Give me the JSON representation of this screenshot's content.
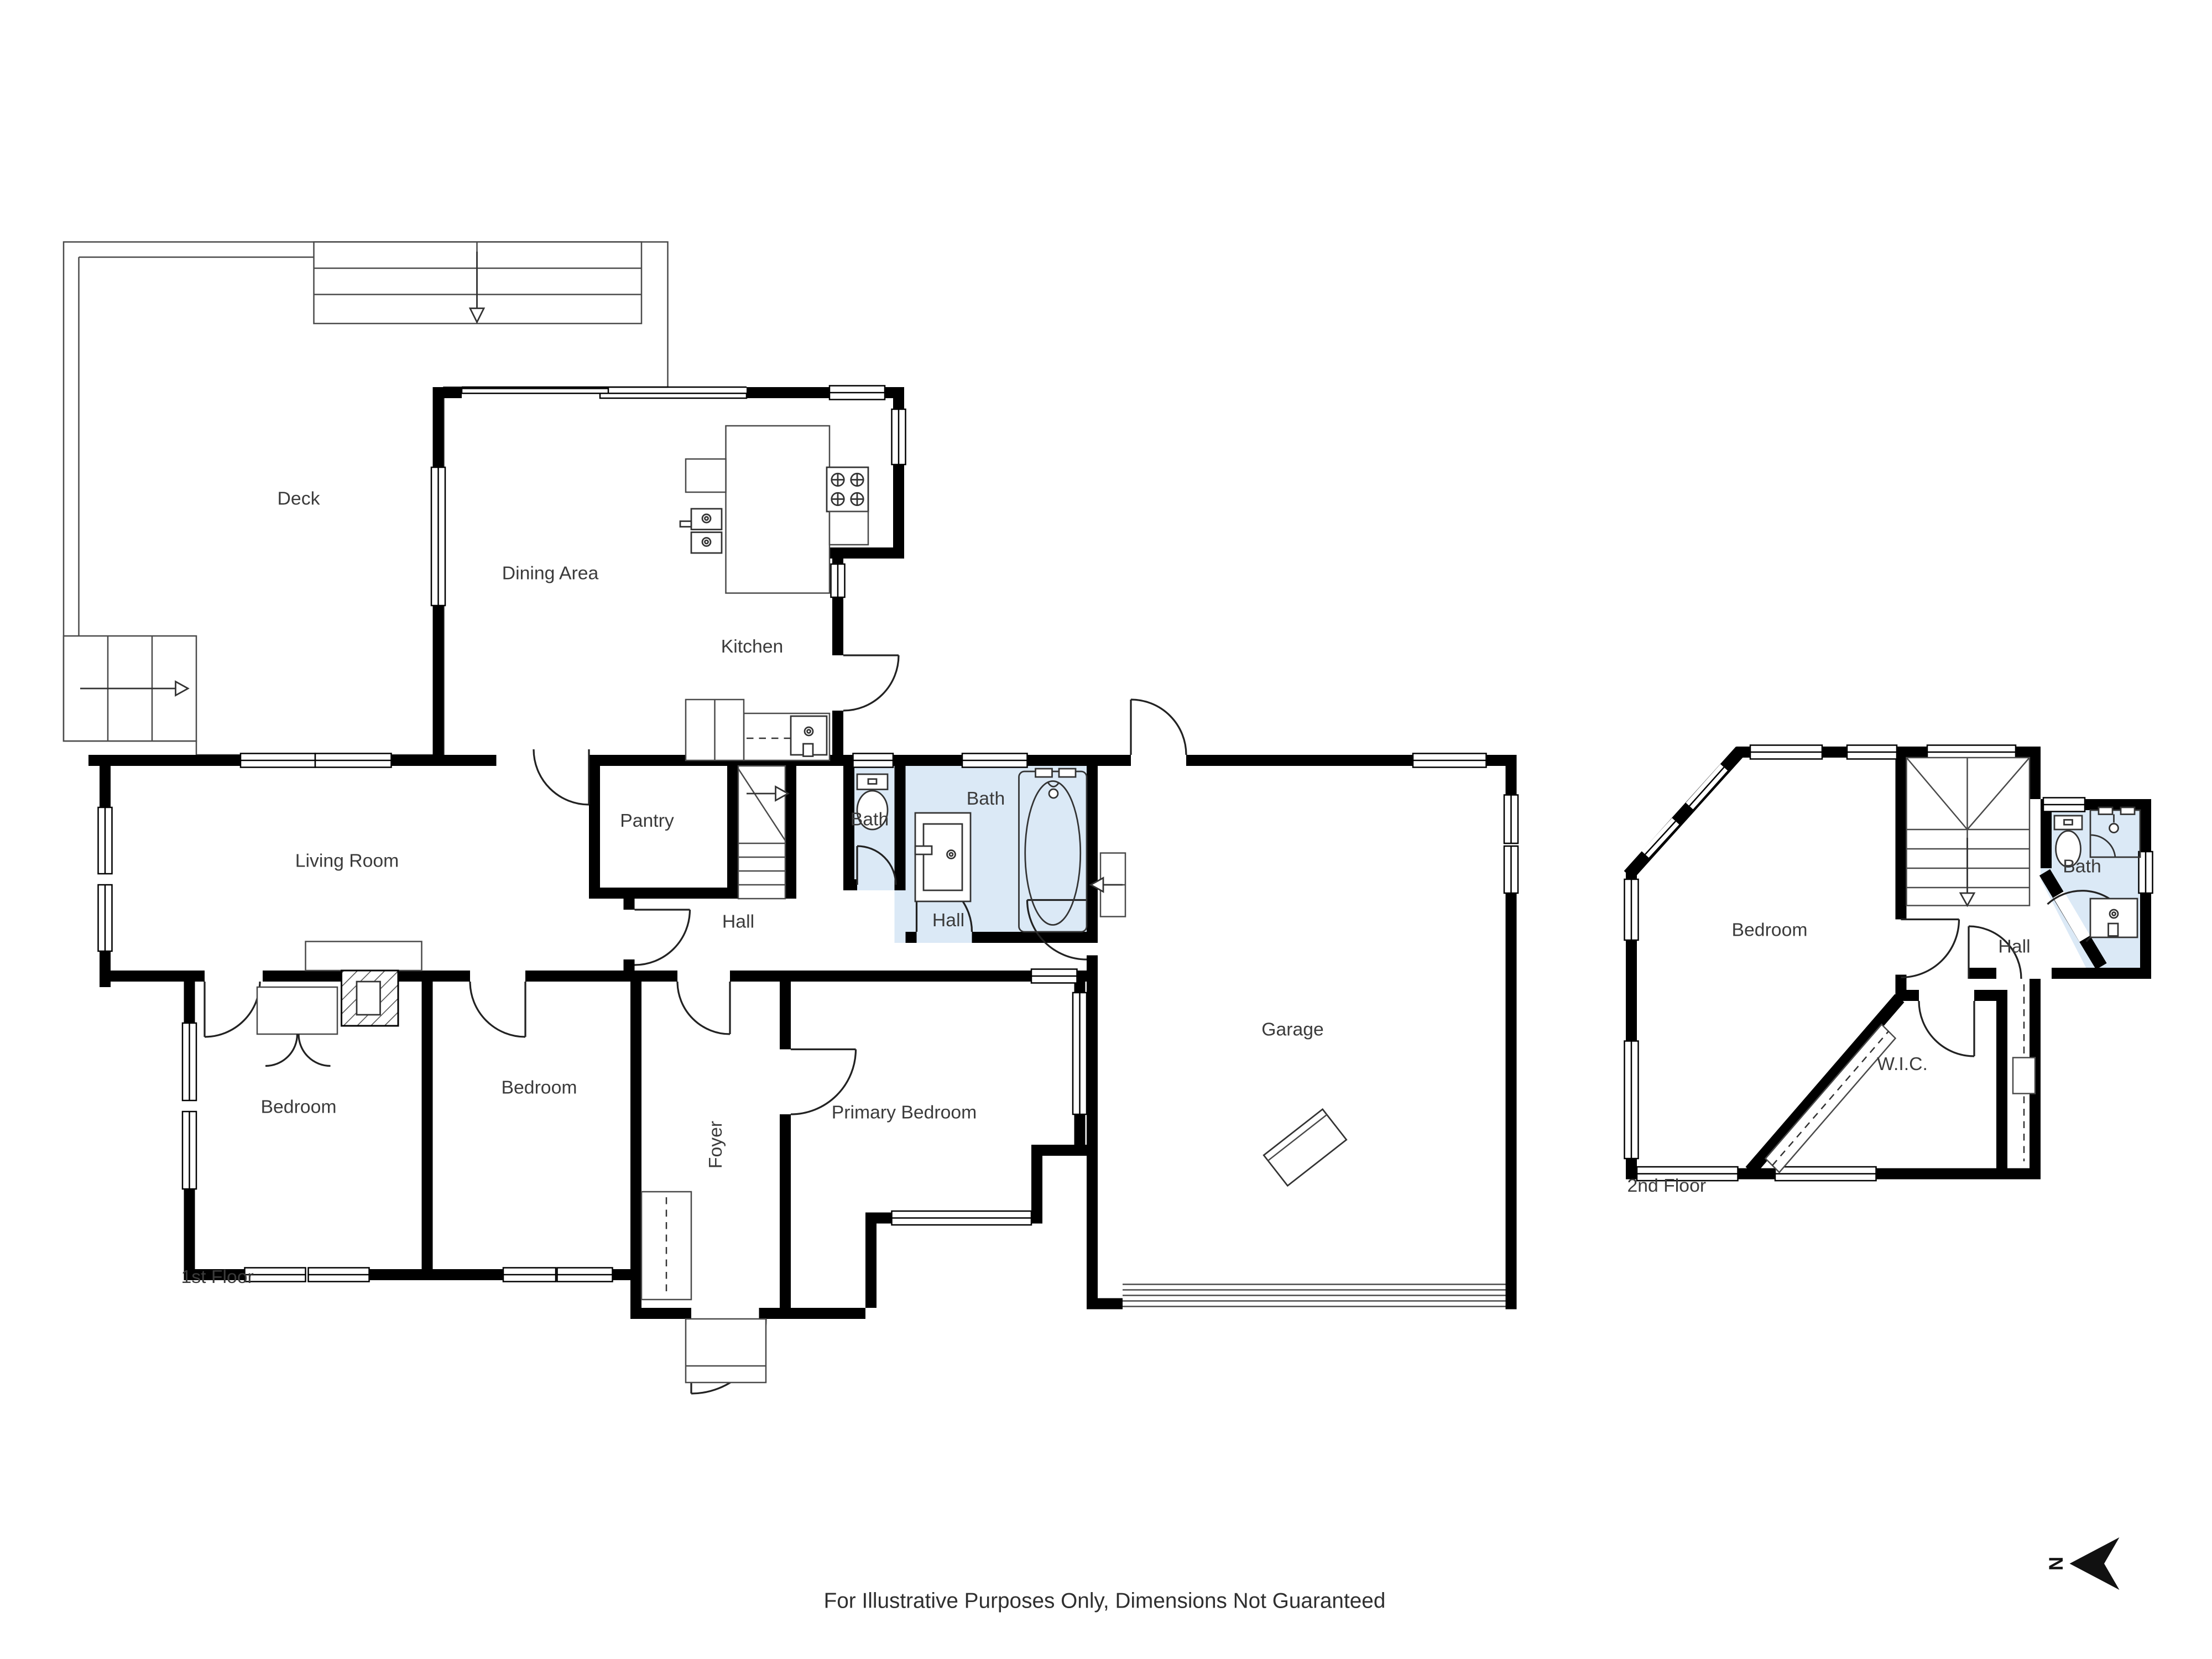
{
  "colors": {
    "wall": "#000000",
    "bath_fill": "#dbe9f6",
    "line": "#4a4a4a",
    "label_text": "#3b3b3b",
    "background": "#ffffff"
  },
  "floors": {
    "first": {
      "caption": "1st Floor",
      "rooms": {
        "deck": "Deck",
        "dining_area": "Dining Area",
        "kitchen": "Kitchen",
        "living_room": "Living Room",
        "pantry": "Pantry",
        "bath_small": "Bath",
        "bath_main": "Bath",
        "hall_west": "Hall",
        "hall_east": "Hall",
        "garage": "Garage",
        "bedroom_west": "Bedroom",
        "bedroom_middle": "Bedroom",
        "primary_bedroom": "Primary Bedroom",
        "foyer": "Foyer"
      }
    },
    "second": {
      "caption": "2nd Floor",
      "rooms": {
        "bedroom": "Bedroom",
        "bath": "Bath",
        "hall": "Hall",
        "walk_in_closet": "W.I.C."
      }
    }
  },
  "compass": {
    "label": "N"
  },
  "footer": {
    "disclaimer": "For Illustrative Purposes Only, Dimensions Not Guaranteed"
  }
}
